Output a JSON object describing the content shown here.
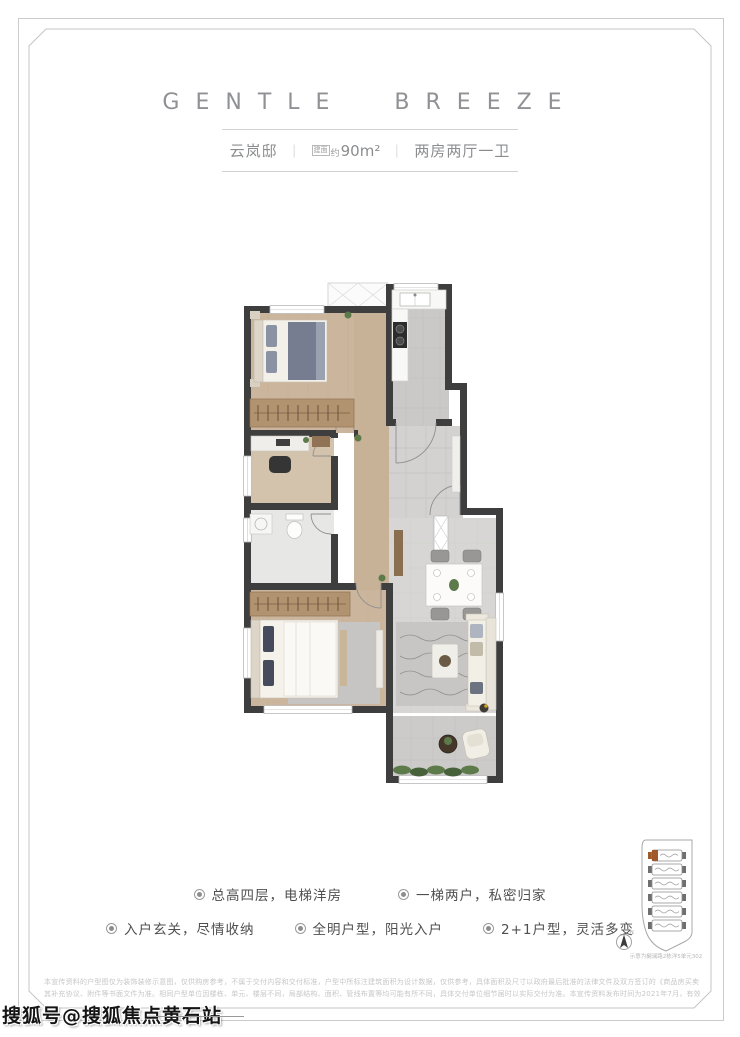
{
  "header": {
    "title": "GENTLE BREEZE",
    "name": "云岚邸",
    "divider": "｜",
    "area_box": "建面",
    "area_approx": "约",
    "area_value": "90m²",
    "layout": "两房两厅一卫"
  },
  "features": {
    "items": [
      {
        "label": "总高四层，电梯洋房"
      },
      {
        "label": "一梯两户，私密归家"
      },
      {
        "label": "入户玄关，尽情收纳"
      },
      {
        "label": "全明户型，阳光入户"
      },
      {
        "label": "2+1户型，灵活多变"
      }
    ]
  },
  "site_diagram": {
    "caption": "示意为樾澜路2栋洋5单元302",
    "compass_label": "N",
    "highlight_color": "#a0592a"
  },
  "disclaimer": {
    "line1": "本宣传资料的户型图仅为装饰装修示意图，仅供购房参考，不属于交付内容和交付标准，户型中所标注建筑面积为设计数据，仅供参考，具体面积及尺寸以政府最后批准的法律文件及双方签订的《商品房买卖合同（预售）》及",
    "line2": "其补充协议、附件等书面文件为准。相同户型单位因楼栋、单元、楼层不同，局部结构、面积、管线布置等均可能有所不同，具体交付单位细节届时以实际交付为准。本宣传资料发布时间为2021年7月，有效期为2021年9月。"
  },
  "watermark": {
    "text": "搜狐号@搜狐焦点黄石站"
  },
  "colors": {
    "wall": "#3e3e3e",
    "wood_floor": "#cbb69d",
    "wardrobe_wood": "#b2936f",
    "tile": "#d6d5d3",
    "plant_green": "#5d7a4a",
    "frame_border": "#cbcbcb",
    "title_gray": "#8f9194"
  }
}
